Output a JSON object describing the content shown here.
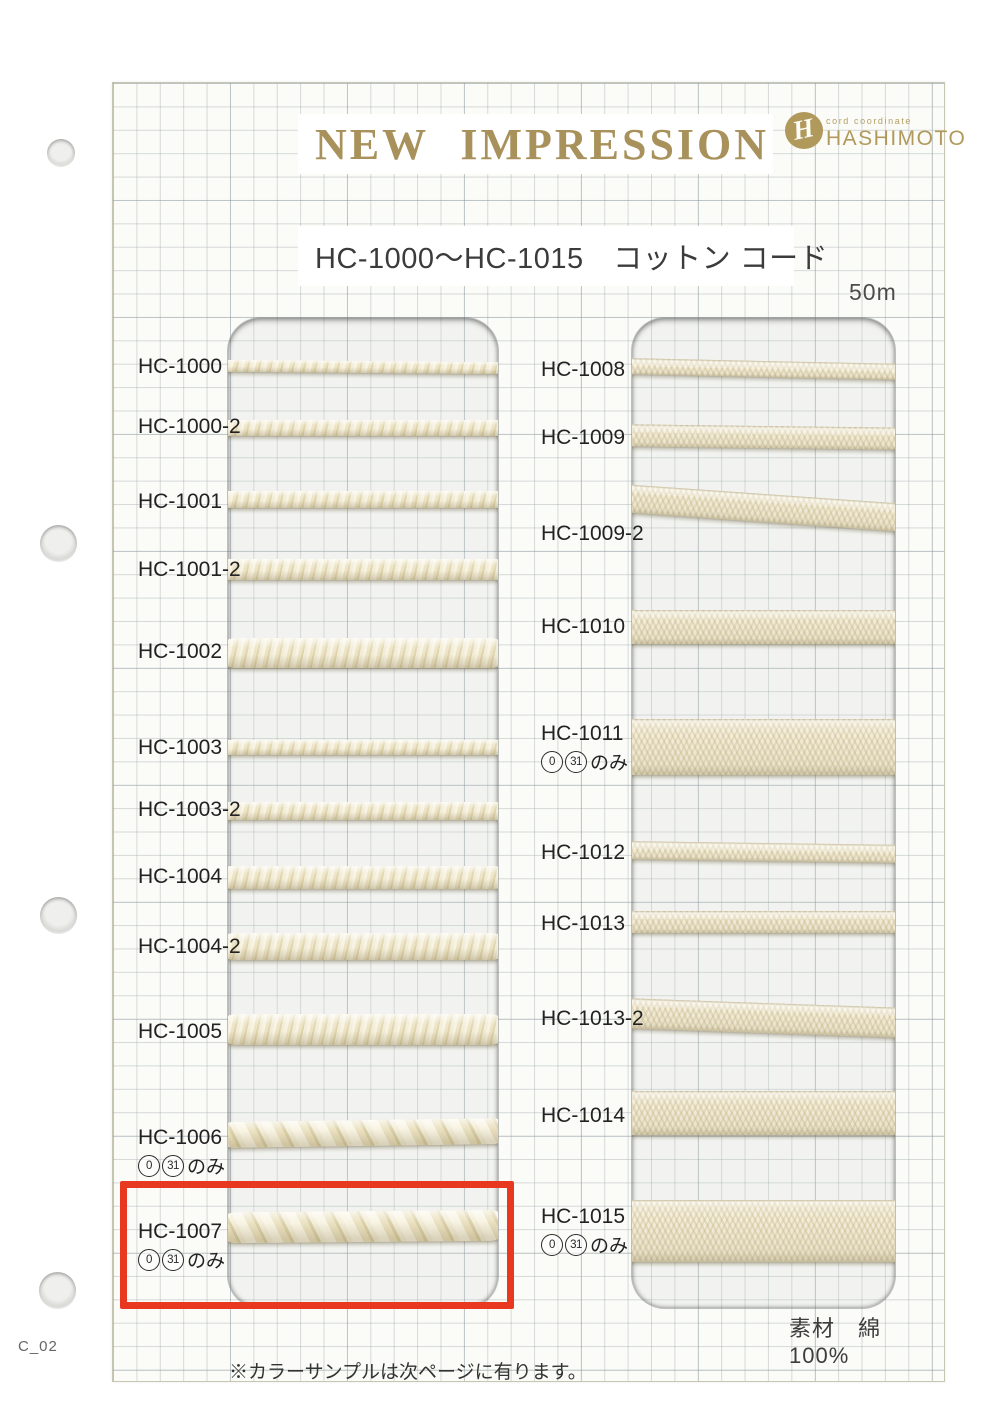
{
  "page": {
    "code": "C_02",
    "footnote": "※カラーサンプルは次ページに有ります。",
    "material_label": "素材　綿 100%"
  },
  "header": {
    "title": "NEW IMPRESSION",
    "logo": {
      "monogram": "H",
      "tagline": "cord coordinate",
      "company": "HASHIMOTO"
    },
    "subtitle": "HC-1000〜HC-1015　コットン コード",
    "length_label": "50m"
  },
  "colors": {
    "brand_gold": "#a8915a",
    "highlight_red": "#e8381f",
    "cord_cream": "#f0e9d0"
  },
  "board": {
    "sheet": {
      "x": 112,
      "y": 82,
      "w": 831,
      "h": 1298
    },
    "windows": [
      {
        "x": 226,
        "y": 316,
        "w": 270,
        "h": 990
      },
      {
        "x": 630,
        "y": 316,
        "w": 263,
        "h": 990
      }
    ],
    "columns": [
      {
        "label_x": 137,
        "samples": [
          {
            "id": "HC-1000",
            "label_y": 366,
            "cord": {
              "type": "braid",
              "y": 359,
              "h": 12,
              "tilt": 0.5
            }
          },
          {
            "id": "HC-1000-2",
            "label_y": 426,
            "cord": {
              "type": "braid",
              "y": 418,
              "h": 16,
              "tilt": 0
            }
          },
          {
            "id": "HC-1001",
            "label_y": 501,
            "cord": {
              "type": "braid",
              "y": 489,
              "h": 17,
              "tilt": 0
            }
          },
          {
            "id": "HC-1001-2",
            "label_y": 569,
            "cord": {
              "type": "braid",
              "y": 557,
              "h": 21,
              "tilt": 0
            }
          },
          {
            "id": "HC-1002",
            "label_y": 651,
            "cord": {
              "type": "braid",
              "y": 636,
              "h": 30,
              "tilt": 0
            }
          },
          {
            "id": "HC-1003",
            "label_y": 747,
            "cord": {
              "type": "braid",
              "y": 738,
              "h": 15,
              "tilt": 0
            }
          },
          {
            "id": "HC-1003-2",
            "label_y": 809,
            "cord": {
              "type": "braid",
              "y": 800,
              "h": 18,
              "tilt": 0
            }
          },
          {
            "id": "HC-1004",
            "label_y": 876,
            "cord": {
              "type": "braid",
              "y": 864,
              "h": 23,
              "tilt": 0
            }
          },
          {
            "id": "HC-1004-2",
            "label_y": 946,
            "cord": {
              "type": "braid",
              "y": 931,
              "h": 27,
              "tilt": 0
            }
          },
          {
            "id": "HC-1005",
            "label_y": 1031,
            "cord": {
              "type": "braid",
              "y": 1012,
              "h": 31,
              "tilt": 0
            }
          },
          {
            "id": "HC-1006",
            "label_y": 1137,
            "note": {
              "circled": [
                "0",
                "31"
              ],
              "suffix": "のみ"
            },
            "cord": {
              "type": "twist",
              "y": 1118,
              "h": 26,
              "tilt": -0.8
            }
          },
          {
            "id": "HC-1007",
            "label_y": 1231,
            "note": {
              "circled": [
                "0",
                "31"
              ],
              "suffix": "のみ"
            },
            "cord": {
              "type": "twist",
              "y": 1209,
              "h": 31,
              "tilt": -0.5
            }
          }
        ]
      },
      {
        "label_x": 540,
        "samples": [
          {
            "id": "HC-1008",
            "label_y": 369,
            "cord": {
              "type": "tape",
              "y": 359,
              "h": 16,
              "tilt": 1.2
            }
          },
          {
            "id": "HC-1009",
            "label_y": 437,
            "cord": {
              "type": "tape",
              "y": 424,
              "h": 22,
              "tilt": 0.7
            }
          },
          {
            "id": "HC-1009-2",
            "label_y": 533,
            "cord": {
              "type": "tape",
              "y": 492,
              "h": 28,
              "tilt": 4
            }
          },
          {
            "id": "HC-1010",
            "label_y": 626,
            "cord": {
              "type": "tape",
              "y": 608,
              "h": 34,
              "tilt": 0
            }
          },
          {
            "id": "HC-1011",
            "label_y": 733,
            "note": {
              "circled": [
                "0",
                "31"
              ],
              "suffix": "のみ"
            },
            "cord": {
              "type": "tape",
              "y": 717,
              "h": 56,
              "tilt": 0
            }
          },
          {
            "id": "HC-1012",
            "label_y": 852,
            "cord": {
              "type": "tape",
              "y": 841,
              "h": 18,
              "tilt": 0.8
            }
          },
          {
            "id": "HC-1013",
            "label_y": 923,
            "cord": {
              "type": "tape",
              "y": 909,
              "h": 22,
              "tilt": 0
            }
          },
          {
            "id": "HC-1013-2",
            "label_y": 1018,
            "cord": {
              "type": "tape",
              "y": 1001,
              "h": 30,
              "tilt": 2
            }
          },
          {
            "id": "HC-1014",
            "label_y": 1115,
            "cord": {
              "type": "tape",
              "y": 1089,
              "h": 44,
              "tilt": 0
            }
          },
          {
            "id": "HC-1015",
            "label_y": 1216,
            "note": {
              "circled": [
                "0",
                "31"
              ],
              "suffix": "のみ"
            },
            "cord": {
              "type": "tape",
              "y": 1198,
              "h": 62,
              "tilt": 0
            }
          }
        ]
      }
    ],
    "highlight": {
      "sample_id": "HC-1007",
      "x": 119,
      "y": 1180,
      "w": 394,
      "h": 128
    }
  },
  "punch_holes": [
    {
      "cx": 61,
      "cy": 153,
      "d": 28
    },
    {
      "cx": 58,
      "cy": 543,
      "d": 37
    },
    {
      "cx": 58,
      "cy": 915,
      "d": 37
    },
    {
      "cx": 57,
      "cy": 1290,
      "d": 37
    }
  ]
}
